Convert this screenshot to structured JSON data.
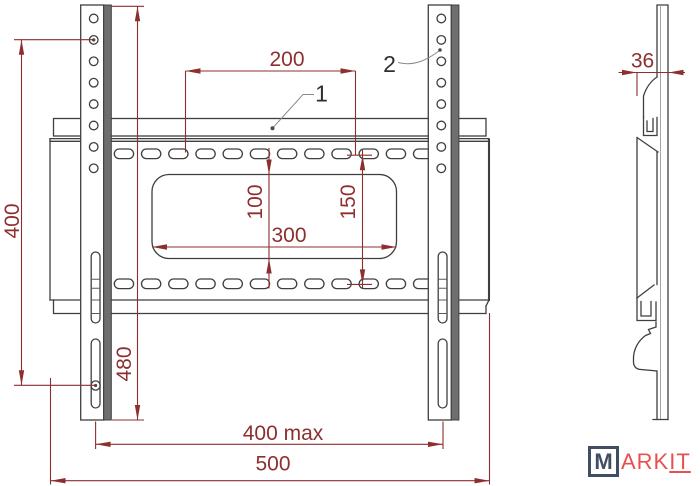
{
  "drawing": {
    "part_labels": {
      "plate": "1",
      "rail": "2"
    },
    "dimensions": {
      "overall_height": "400",
      "rail_height": "480",
      "hole_spacing_h": "200",
      "cutout_height": "100",
      "row_spacing": "150",
      "cutout_width": "300",
      "max_mount_width": "400 max",
      "plate_width": "500",
      "depth": "36"
    },
    "colors": {
      "dimension": "#8e2f2f",
      "outline": "#3f3f3f",
      "leader": "#8a8a8a",
      "flange": "#6f6f6f"
    },
    "logo": {
      "boxed": "M",
      "text": "ARK",
      "underlined": "IT",
      "red": "#e8504f",
      "navy": "#3f4e63"
    }
  }
}
